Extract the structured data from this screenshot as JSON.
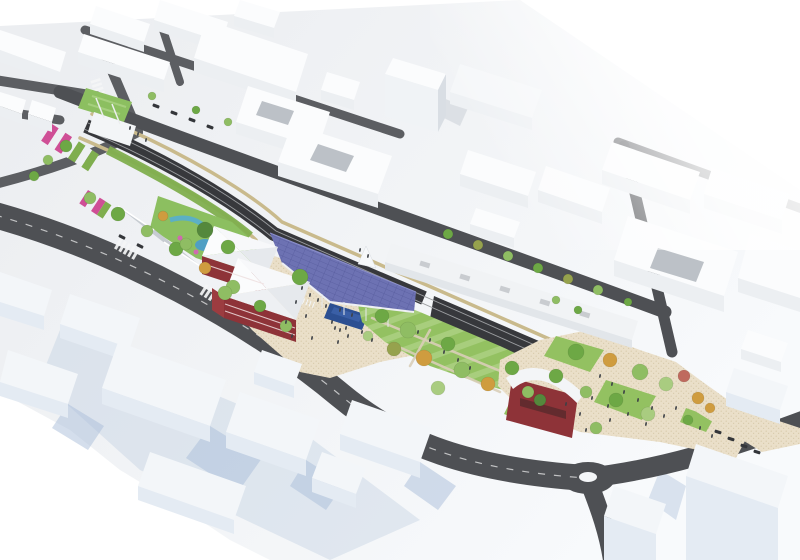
{
  "scene": {
    "kind": "urban-masterplan-3d-aerial-rendering",
    "palette": {
      "bg": "#ffffff",
      "ground_a": "#eceef1",
      "ground_b": "#f8fafc",
      "road": "#4e5054",
      "road_minor": "#5c5e62",
      "trench": "#37383c",
      "rail": "#9b9da0",
      "wall_tan": "#c9ba8c",
      "lawn": "#93c161",
      "lawn_light": "#aed387",
      "lawn_dark": "#7fae4e",
      "park_patch": "#8cbf60",
      "solar": "#6d72b3",
      "solar_line": "#575c9e",
      "plaza": "#eadfc9",
      "plaza_dot": "#d8cbab",
      "pool": "#2c4f92",
      "pool_light": "#3f63ab",
      "red_wall": "#8e3338",
      "red_dark": "#7c2b30",
      "red_bright": "#9c3c40",
      "roof_white": "#f4f6f8",
      "roof_shade": "#e2e6ea",
      "bldg_top": "#fbfcfd",
      "bldg_face": "#eceff2",
      "bldg_side": "#d9dee4",
      "bldg_face_blue": "#e4ebf3",
      "bldg_side_blue": "#cfdae7",
      "shadow_blue": "#a9bdd9",
      "courtyard": "#a7adb4",
      "tree_g1": "#6da845",
      "tree_g2": "#8fbd63",
      "tree_g3": "#a9cc80",
      "tree_olive": "#96a24d",
      "tree_orange": "#cf9c3f",
      "tree_darkgreen": "#54883c",
      "tree_red": "#bf6a5e",
      "people": "#3c4046",
      "car": "#34363a",
      "pergola": "#c7ccd2",
      "blue_play": "#57aecf",
      "pink": "#cf4f96"
    },
    "stripe_colors": {
      "pink": "#cf4f96",
      "white": "#eef1f3",
      "green": "#7fae4e"
    },
    "ramp_bands": [
      {
        "x": 52,
        "y": 124,
        "rot": 33,
        "h": 20,
        "w": 8,
        "stripes": [
          "pink",
          "white",
          "pink",
          "white",
          "green",
          "white",
          "green"
        ]
      },
      {
        "x": 88,
        "y": 190,
        "rot": 33,
        "h": 16,
        "w": 7,
        "stripes": [
          "pink",
          "white",
          "pink",
          "green",
          "white"
        ]
      }
    ],
    "trees": [
      [
        90,
        198,
        6,
        "g2"
      ],
      [
        118,
        214,
        7,
        "g1"
      ],
      [
        147,
        231,
        6,
        "g2"
      ],
      [
        176,
        249,
        7,
        "g1"
      ],
      [
        205,
        268,
        6,
        "or"
      ],
      [
        233,
        287,
        7,
        "g2"
      ],
      [
        260,
        306,
        6,
        "g1"
      ],
      [
        286,
        326,
        6,
        "g2"
      ],
      [
        66,
        146,
        6,
        "g1"
      ],
      [
        48,
        160,
        5,
        "g2"
      ],
      [
        34,
        176,
        5,
        "g1"
      ],
      [
        152,
        96,
        4,
        "g2"
      ],
      [
        196,
        110,
        4,
        "g1"
      ],
      [
        228,
        122,
        4,
        "g2"
      ],
      [
        448,
        234,
        5,
        "g1"
      ],
      [
        478,
        245,
        5,
        "ol"
      ],
      [
        508,
        256,
        5,
        "g2"
      ],
      [
        538,
        268,
        5,
        "g1"
      ],
      [
        568,
        279,
        5,
        "ol"
      ],
      [
        598,
        290,
        5,
        "g2"
      ],
      [
        628,
        302,
        4,
        "g1"
      ],
      [
        205,
        230,
        8,
        "dg"
      ],
      [
        228,
        247,
        7,
        "g1"
      ],
      [
        186,
        244,
        6,
        "g2"
      ],
      [
        163,
        216,
        5,
        "or"
      ],
      [
        300,
        277,
        8,
        "g1"
      ],
      [
        225,
        293,
        7,
        "g2"
      ],
      [
        382,
        316,
        7,
        "g1"
      ],
      [
        408,
        330,
        8,
        "g2"
      ],
      [
        394,
        349,
        7,
        "ol"
      ],
      [
        424,
        358,
        8,
        "or"
      ],
      [
        448,
        344,
        7,
        "g1"
      ],
      [
        462,
        370,
        8,
        "g2"
      ],
      [
        488,
        384,
        7,
        "or"
      ],
      [
        438,
        388,
        7,
        "g3"
      ],
      [
        512,
        368,
        7,
        "g1"
      ],
      [
        528,
        392,
        6,
        "g2"
      ],
      [
        368,
        336,
        5,
        "g3"
      ],
      [
        576,
        352,
        8,
        "g1"
      ],
      [
        610,
        360,
        7,
        "or"
      ],
      [
        640,
        372,
        8,
        "g2"
      ],
      [
        666,
        384,
        7,
        "g3"
      ],
      [
        698,
        398,
        6,
        "or"
      ],
      [
        616,
        400,
        7,
        "g1"
      ],
      [
        586,
        392,
        6,
        "g2"
      ],
      [
        648,
        414,
        7,
        "g3"
      ],
      [
        688,
        420,
        5,
        "g1"
      ],
      [
        710,
        408,
        5,
        "or"
      ],
      [
        556,
        376,
        7,
        "g1"
      ],
      [
        540,
        400,
        6,
        "dg"
      ],
      [
        596,
        428,
        6,
        "g2"
      ],
      [
        684,
        376,
        6,
        "rt"
      ],
      [
        556,
        300,
        4,
        "g2"
      ],
      [
        578,
        310,
        4,
        "g1"
      ]
    ],
    "people": [
      [
        302,
        288
      ],
      [
        310,
        295
      ],
      [
        318,
        300
      ],
      [
        296,
        302
      ],
      [
        326,
        306
      ],
      [
        340,
        310
      ],
      [
        352,
        315
      ],
      [
        306,
        316
      ],
      [
        286,
        322
      ],
      [
        332,
        322
      ],
      [
        346,
        328
      ],
      [
        362,
        332
      ],
      [
        372,
        340
      ],
      [
        338,
        342
      ],
      [
        312,
        338
      ],
      [
        292,
        336
      ],
      [
        360,
        250
      ],
      [
        368,
        256
      ],
      [
        418,
        332
      ],
      [
        430,
        340
      ],
      [
        444,
        352
      ],
      [
        458,
        360
      ],
      [
        470,
        368
      ],
      [
        340,
        330
      ],
      [
        335,
        328
      ],
      [
        348,
        336
      ],
      [
        600,
        376
      ],
      [
        612,
        384
      ],
      [
        624,
        392
      ],
      [
        638,
        400
      ],
      [
        652,
        408
      ],
      [
        592,
        398
      ],
      [
        608,
        406
      ],
      [
        628,
        414
      ],
      [
        646,
        424
      ],
      [
        664,
        416
      ],
      [
        676,
        408
      ],
      [
        580,
        414
      ],
      [
        566,
        404
      ],
      [
        700,
        428
      ],
      [
        712,
        436
      ],
      [
        586,
        430
      ],
      [
        610,
        420
      ],
      [
        130,
        128
      ],
      [
        138,
        134
      ],
      [
        146,
        140
      ]
    ],
    "cars": [
      [
        156,
        106,
        21
      ],
      [
        174,
        113,
        21
      ],
      [
        192,
        120,
        21
      ],
      [
        210,
        127,
        21
      ],
      [
        718,
        432,
        18
      ],
      [
        731,
        439,
        18
      ],
      [
        744,
        446,
        18
      ],
      [
        757,
        452,
        18
      ],
      [
        122,
        237,
        27
      ],
      [
        140,
        246,
        27
      ]
    ]
  }
}
